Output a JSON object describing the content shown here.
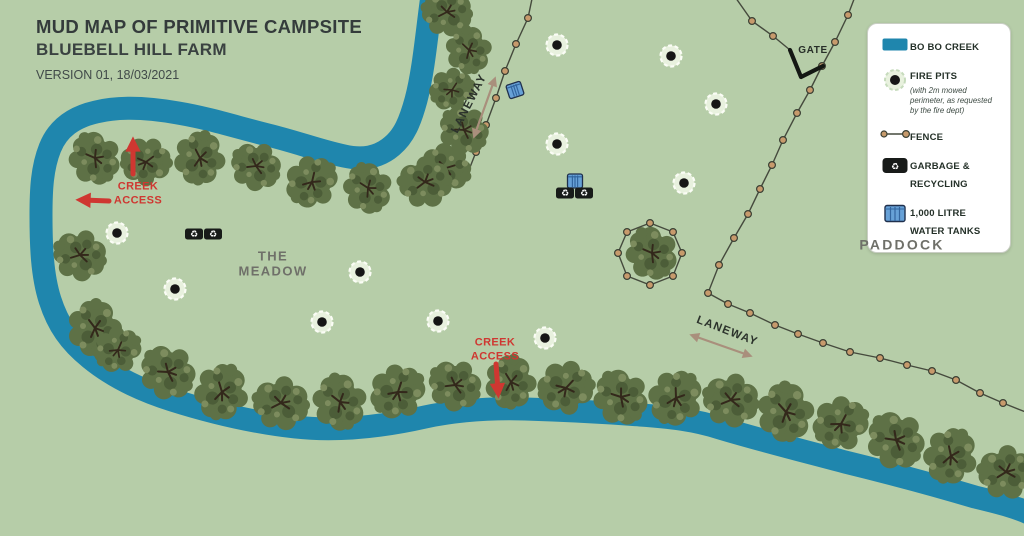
{
  "title": {
    "line1": "MUD MAP OF PRIMITIVE CAMPSITE",
    "line2": "BLUEBELL HILL FARM",
    "version": "VERSION 01, 18/03/2021"
  },
  "legend": {
    "items": [
      {
        "icon": "creek-swatch",
        "label": "BO BO CREEK",
        "note": ""
      },
      {
        "icon": "fire-pit-icon",
        "label": "FIRE PITS",
        "note": "(with 2m mowed perimeter, as requested by the fire dept)"
      },
      {
        "icon": "fence-icon",
        "label": "FENCE",
        "note": ""
      },
      {
        "icon": "garbage-icon",
        "label": "GARBAGE & RECYCLING",
        "note": ""
      },
      {
        "icon": "water-tank-icon",
        "label": "1,000 LITRE WATER TANKS",
        "note": ""
      }
    ]
  },
  "map_labels": [
    {
      "id": "the-meadow",
      "text": "THE\nMEADOW",
      "x": 273,
      "y": 264,
      "class": "lbl-area",
      "rot": 0
    },
    {
      "id": "paddock",
      "text": "PADDOCK",
      "x": 902,
      "y": 245,
      "class": "lbl-area lbl-paddock",
      "rot": 0
    },
    {
      "id": "gate",
      "text": "GATE",
      "x": 813,
      "y": 51,
      "class": "lbl-gate",
      "rot": 0
    },
    {
      "id": "laneway-top",
      "text": "LANEWAY",
      "x": 470,
      "y": 104,
      "class": "lbl-laneway",
      "rot": -63
    },
    {
      "id": "laneway-bottom",
      "text": "LANEWAY",
      "x": 727,
      "y": 332,
      "class": "lbl-laneway",
      "rot": 21
    },
    {
      "id": "creek-access-upper",
      "text": "CREEK\nACCESS",
      "x": 138,
      "y": 194,
      "class": "lbl-creek-access",
      "rot": 0
    },
    {
      "id": "creek-access-lower",
      "text": "CREEK\nACCESS",
      "x": 495,
      "y": 350,
      "class": "lbl-creek-access",
      "rot": 0
    }
  ],
  "map": {
    "garbage_glyph": "♻",
    "fire_pits": [
      [
        557,
        45
      ],
      [
        671,
        56
      ],
      [
        716,
        104
      ],
      [
        557,
        144
      ],
      [
        684,
        183
      ],
      [
        117,
        233
      ],
      [
        175,
        289
      ],
      [
        360,
        272
      ],
      [
        322,
        322
      ],
      [
        438,
        321
      ],
      [
        545,
        338
      ]
    ],
    "water_tanks": [
      [
        515,
        90,
        -18
      ],
      [
        575,
        181,
        0
      ]
    ],
    "garbage_bins": [
      [
        565,
        193
      ],
      [
        584,
        193
      ],
      [
        194,
        234
      ],
      [
        213,
        234
      ]
    ],
    "fences": [
      {
        "points": [
          [
            533,
            -6
          ],
          [
            528,
            18
          ],
          [
            516,
            44
          ],
          [
            505,
            71
          ],
          [
            496,
            98
          ],
          [
            486,
            125
          ],
          [
            476,
            152
          ],
          [
            465,
            180
          ]
        ],
        "posts": [
          [
            528,
            18
          ],
          [
            516,
            44
          ],
          [
            505,
            71
          ],
          [
            496,
            98
          ],
          [
            486,
            125
          ],
          [
            476,
            152
          ]
        ]
      },
      {
        "points": [
          [
            733,
            -6
          ],
          [
            752,
            21
          ],
          [
            773,
            36
          ],
          [
            790,
            50
          ]
        ],
        "posts": [
          [
            752,
            21
          ],
          [
            773,
            36
          ]
        ]
      },
      {
        "points": [
          [
            856,
            -6
          ],
          [
            848,
            15
          ],
          [
            835,
            42
          ],
          [
            822,
            66
          ],
          [
            810,
            90
          ],
          [
            797,
            113
          ],
          [
            783,
            140
          ],
          [
            772,
            165
          ],
          [
            760,
            189
          ],
          [
            748,
            214
          ],
          [
            734,
            238
          ],
          [
            719,
            265
          ],
          [
            708,
            293
          ],
          [
            728,
            304
          ],
          [
            750,
            313
          ],
          [
            775,
            325
          ],
          [
            798,
            334
          ],
          [
            823,
            343
          ],
          [
            850,
            352
          ],
          [
            880,
            358
          ],
          [
            907,
            365
          ],
          [
            932,
            371
          ],
          [
            956,
            380
          ],
          [
            980,
            393
          ],
          [
            1003,
            403
          ],
          [
            1028,
            413
          ]
        ],
        "posts": [
          [
            848,
            15
          ],
          [
            835,
            42
          ],
          [
            822,
            66
          ],
          [
            810,
            90
          ],
          [
            797,
            113
          ],
          [
            783,
            140
          ],
          [
            772,
            165
          ],
          [
            760,
            189
          ],
          [
            748,
            214
          ],
          [
            734,
            238
          ],
          [
            719,
            265
          ],
          [
            708,
            293
          ],
          [
            728,
            304
          ],
          [
            750,
            313
          ],
          [
            775,
            325
          ],
          [
            798,
            334
          ],
          [
            823,
            343
          ],
          [
            850,
            352
          ],
          [
            880,
            358
          ],
          [
            907,
            365
          ],
          [
            932,
            371
          ],
          [
            956,
            380
          ],
          [
            980,
            393
          ],
          [
            1003,
            403
          ]
        ]
      }
    ],
    "tree_fence": {
      "points": [
        [
          650,
          223
        ],
        [
          673,
          232
        ],
        [
          682,
          253
        ],
        [
          673,
          276
        ],
        [
          650,
          285
        ],
        [
          627,
          276
        ],
        [
          618,
          253
        ],
        [
          627,
          232
        ],
        [
          650,
          223
        ]
      ],
      "posts": [
        [
          650,
          223
        ],
        [
          673,
          232
        ],
        [
          682,
          253
        ],
        [
          673,
          276
        ],
        [
          650,
          285
        ],
        [
          627,
          276
        ],
        [
          618,
          253
        ],
        [
          627,
          232
        ]
      ]
    },
    "gate_path": [
      [
        790,
        50
      ],
      [
        801,
        77
      ],
      [
        823,
        66
      ]
    ],
    "arrows": [
      {
        "kind": "red",
        "x1": 133,
        "y1": 174,
        "x2": 133,
        "y2": 144,
        "double": false
      },
      {
        "kind": "red",
        "x1": 109,
        "y1": 201,
        "x2": 83,
        "y2": 200,
        "double": false
      },
      {
        "kind": "red",
        "x1": 496,
        "y1": 364,
        "x2": 498,
        "y2": 391,
        "double": false
      },
      {
        "kind": "tan",
        "x1": 475,
        "y1": 134,
        "x2": 494,
        "y2": 81,
        "double": true
      },
      {
        "kind": "tan",
        "x1": 694,
        "y1": 336,
        "x2": 748,
        "y2": 355,
        "double": true
      }
    ],
    "trees": [
      [
        447,
        12,
        0.9,
        10
      ],
      [
        469,
        50,
        0.85,
        80
      ],
      [
        452,
        90,
        0.8,
        160
      ],
      [
        464,
        130,
        0.9,
        40
      ],
      [
        446,
        168,
        0.9,
        200
      ],
      [
        425,
        182,
        0.95,
        0
      ],
      [
        368,
        188,
        0.9,
        70
      ],
      [
        312,
        182,
        0.95,
        140
      ],
      [
        256,
        166,
        0.9,
        30
      ],
      [
        200,
        158,
        0.95,
        100
      ],
      [
        146,
        162,
        0.9,
        180
      ],
      [
        95,
        158,
        0.95,
        60
      ],
      [
        80,
        255,
        0.95,
        20
      ],
      [
        95,
        328,
        1.0,
        90
      ],
      [
        118,
        350,
        0.85,
        150
      ],
      [
        168,
        372,
        1.0,
        40
      ],
      [
        222,
        392,
        1.0,
        110
      ],
      [
        281,
        403,
        1.0,
        10
      ],
      [
        340,
        402,
        1.0,
        75
      ],
      [
        398,
        392,
        1.0,
        145
      ],
      [
        455,
        385,
        0.95,
        30
      ],
      [
        511,
        382,
        0.95,
        95
      ],
      [
        566,
        388,
        1.0,
        170
      ],
      [
        621,
        397,
        1.0,
        55
      ],
      [
        676,
        398,
        1.0,
        125
      ],
      [
        731,
        400,
        1.0,
        15
      ],
      [
        786,
        412,
        1.05,
        85
      ],
      [
        841,
        424,
        1.0,
        155
      ],
      [
        896,
        440,
        1.05,
        45
      ],
      [
        951,
        456,
        1.0,
        115
      ],
      [
        1006,
        472,
        1.0,
        5
      ],
      [
        652,
        253,
        0.95,
        60
      ]
    ]
  },
  "colors": {
    "bg": "#b6cda8",
    "creek": "#1f86ad",
    "tree": "#5e7146",
    "tree_dark": "#4c5d38",
    "tree_light": "#7d8c5e",
    "red": "#cf3731",
    "tan": "#a98f7c",
    "ink": "#343b3b",
    "area_label": "#6f7069",
    "fence_post": "#c79a6c"
  }
}
